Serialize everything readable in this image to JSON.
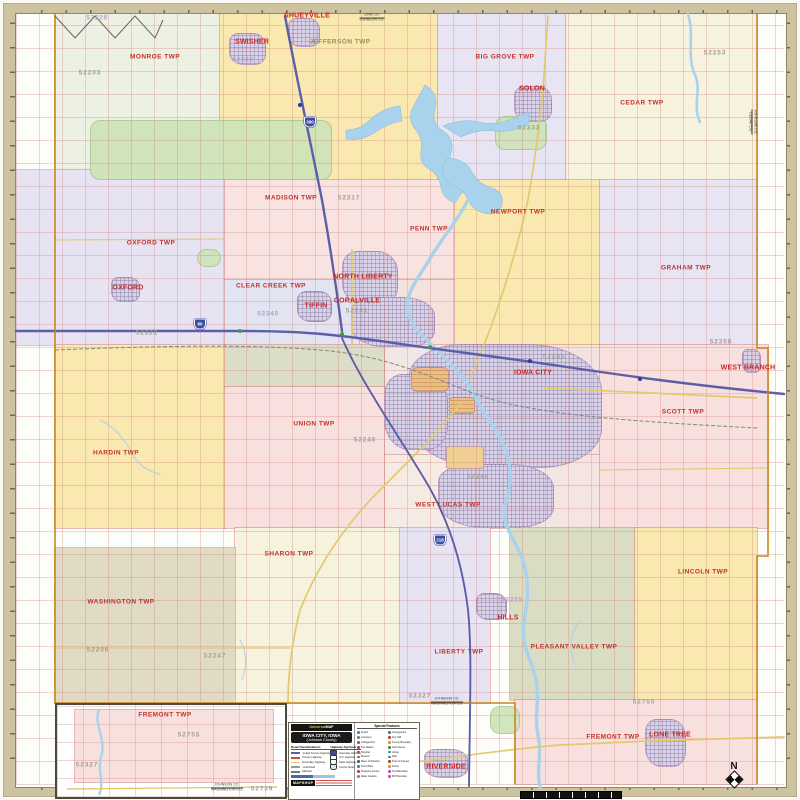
{
  "meta": {
    "product_title": "Iowa City, Iowa (Johnson County) wall map"
  },
  "palette": {
    "frame_tan": "#cdc3a1",
    "township_yellow": "#f9e8b0",
    "township_lavender": "#e8e4f3",
    "township_pink": "#f8e0de",
    "township_cream": "#f6f2de",
    "township_tan": "#e1dbc5",
    "township_olive": "#dadcc3",
    "urban_purple": "#d9d2e8",
    "water_blue": "#a9d2ec",
    "park_green": "#cde3b8",
    "interstate_purple": "#5c5fa8",
    "highway_yellow": "#e3c96e",
    "town_label_red": "#cc2522",
    "zip_gray": "#a29e8f",
    "zip_purple": "#b1a0c9",
    "county_line_orange": "#c8881f"
  },
  "map": {
    "regions": [
      {
        "id": "monroe-twp",
        "x": 55,
        "y": 14,
        "w": 165,
        "h": 156,
        "fill": "#edf1e3"
      },
      {
        "id": "jefferson-twp",
        "x": 220,
        "y": 14,
        "w": 218,
        "h": 166,
        "fill": "#f9e8b0"
      },
      {
        "id": "big-grove-twp",
        "x": 438,
        "y": 14,
        "w": 128,
        "h": 166,
        "fill": "#e8e4f3"
      },
      {
        "id": "cedar-twp",
        "x": 566,
        "y": 14,
        "w": 191,
        "h": 166,
        "fill": "#f6f2de"
      },
      {
        "id": "oxford-twp",
        "x": 16,
        "y": 170,
        "w": 209,
        "h": 175,
        "fill": "#e7e3f2"
      },
      {
        "id": "madison-twp",
        "x": 225,
        "y": 180,
        "w": 230,
        "h": 100,
        "fill": "#f8e3e1"
      },
      {
        "id": "clear-creek-twp",
        "x": 225,
        "y": 280,
        "w": 135,
        "h": 65,
        "fill": "#e3e4f1"
      },
      {
        "id": "penn-twp-south",
        "x": 360,
        "y": 280,
        "w": 95,
        "h": 65,
        "fill": "#f5e2dd"
      },
      {
        "id": "newport-twp",
        "x": 455,
        "y": 180,
        "w": 145,
        "h": 165,
        "fill": "#f9e8b0"
      },
      {
        "id": "graham-twp",
        "x": 600,
        "y": 180,
        "w": 157,
        "h": 165,
        "fill": "#e8e4f3"
      },
      {
        "id": "hardin-twp",
        "x": 55,
        "y": 345,
        "w": 170,
        "h": 183,
        "fill": "#f9e8b0"
      },
      {
        "id": "clear-creek-olive",
        "x": 225,
        "y": 345,
        "w": 160,
        "h": 42,
        "fill": "#dcddc6"
      },
      {
        "id": "union-twp",
        "x": 225,
        "y": 387,
        "w": 160,
        "h": 141,
        "fill": "#f8e0de"
      },
      {
        "id": "iowa-city-west-base",
        "x": 385,
        "y": 345,
        "w": 145,
        "h": 110,
        "fill": "#f1e7e7"
      },
      {
        "id": "iowa-city-east-base",
        "x": 530,
        "y": 345,
        "w": 70,
        "h": 110,
        "fill": "#f4e2e0"
      },
      {
        "id": "west-lucas-twp",
        "x": 385,
        "y": 455,
        "w": 145,
        "h": 73,
        "fill": "#f6ebe4"
      },
      {
        "id": "east-lucas-south",
        "x": 530,
        "y": 455,
        "w": 70,
        "h": 73,
        "fill": "#f4e4e2"
      },
      {
        "id": "scott-twp",
        "x": 600,
        "y": 345,
        "w": 168,
        "h": 183,
        "fill": "#f8e0de"
      },
      {
        "id": "sharon-twp",
        "x": 235,
        "y": 528,
        "w": 165,
        "h": 175,
        "fill": "#f6f2de"
      },
      {
        "id": "washington-twp",
        "x": 55,
        "y": 548,
        "w": 180,
        "h": 155,
        "fill": "#e1dbc5"
      },
      {
        "id": "liberty-twp",
        "x": 400,
        "y": 528,
        "w": 90,
        "h": 175,
        "fill": "#e7e3f2"
      },
      {
        "id": "pleasant-valley-twp",
        "x": 510,
        "y": 528,
        "w": 125,
        "h": 172,
        "fill": "#dadcc3"
      },
      {
        "id": "lincoln-twp",
        "x": 635,
        "y": 528,
        "w": 122,
        "h": 172,
        "fill": "#f9e8b0"
      },
      {
        "id": "fremont-twp",
        "x": 515,
        "y": 700,
        "w": 242,
        "h": 84,
        "fill": "#f8e0de"
      }
    ],
    "greens": [
      {
        "id": "hawkeye-wildlife-area",
        "x": 90,
        "y": 120,
        "w": 240,
        "h": 58
      },
      {
        "id": "lake-macbride-park",
        "x": 495,
        "y": 116,
        "w": 50,
        "h": 32
      },
      {
        "id": "kent-park",
        "x": 197,
        "y": 249,
        "w": 22,
        "h": 16
      },
      {
        "id": "river-junction-green",
        "x": 490,
        "y": 706,
        "w": 28,
        "h": 26
      }
    ],
    "urban_areas": [
      {
        "id": "shueyville-urban",
        "x": 288,
        "y": 18,
        "w": 30,
        "h": 27,
        "variant": ""
      },
      {
        "id": "swisher-urban",
        "x": 229,
        "y": 33,
        "w": 35,
        "h": 30,
        "variant": ""
      },
      {
        "id": "solon-urban",
        "x": 514,
        "y": 86,
        "w": 36,
        "h": 34,
        "variant": ""
      },
      {
        "id": "north-liberty-urban",
        "x": 342,
        "y": 251,
        "w": 54,
        "h": 52,
        "variant": ""
      },
      {
        "id": "tiffin-urban",
        "x": 297,
        "y": 291,
        "w": 33,
        "h": 29,
        "variant": ""
      },
      {
        "id": "coralville-urban",
        "x": 351,
        "y": 297,
        "w": 82,
        "h": 48,
        "variant": ""
      },
      {
        "id": "oxford-urban",
        "x": 111,
        "y": 277,
        "w": 27,
        "h": 23,
        "variant": ""
      },
      {
        "id": "iowa-city-urban-a",
        "x": 408,
        "y": 344,
        "w": 192,
        "h": 122,
        "variant": ""
      },
      {
        "id": "iowa-city-urban-b",
        "x": 384,
        "y": 374,
        "w": 62,
        "h": 74,
        "variant": ""
      },
      {
        "id": "iowa-city-urban-c",
        "x": 438,
        "y": 464,
        "w": 114,
        "h": 62,
        "variant": ""
      },
      {
        "id": "university-campus",
        "x": 411,
        "y": 367,
        "w": 36,
        "h": 23,
        "variant": "orange"
      },
      {
        "id": "campus-east",
        "x": 449,
        "y": 397,
        "w": 24,
        "h": 15,
        "variant": "orange"
      },
      {
        "id": "iowa-city-airport",
        "x": 446,
        "y": 446,
        "w": 36,
        "h": 21,
        "variant": "airport"
      },
      {
        "id": "hills-urban",
        "x": 476,
        "y": 593,
        "w": 29,
        "h": 25,
        "variant": ""
      },
      {
        "id": "riverside-urban",
        "x": 424,
        "y": 749,
        "w": 42,
        "h": 27,
        "variant": ""
      },
      {
        "id": "lone-tree-urban",
        "x": 645,
        "y": 719,
        "w": 39,
        "h": 46,
        "variant": ""
      },
      {
        "id": "west-branch-urban",
        "x": 742,
        "y": 349,
        "w": 17,
        "h": 22,
        "variant": ""
      }
    ],
    "townships": [
      {
        "name": "MONROE TWP",
        "x": 155,
        "y": 57,
        "style": ""
      },
      {
        "name": "JEFFERSON TWP",
        "x": 340,
        "y": 42,
        "style": "olive"
      },
      {
        "name": "BIG GROVE TWP",
        "x": 505,
        "y": 57,
        "style": ""
      },
      {
        "name": "CEDAR TWP",
        "x": 642,
        "y": 103,
        "style": ""
      },
      {
        "name": "MADISON TWP",
        "x": 291,
        "y": 198,
        "style": ""
      },
      {
        "name": "PENN TWP",
        "x": 429,
        "y": 229,
        "style": ""
      },
      {
        "name": "NEWPORT TWP",
        "x": 518,
        "y": 212,
        "style": ""
      },
      {
        "name": "GRAHAM TWP",
        "x": 686,
        "y": 268,
        "style": ""
      },
      {
        "name": "OXFORD TWP",
        "x": 151,
        "y": 243,
        "style": ""
      },
      {
        "name": "CLEAR CREEK TWP",
        "x": 271,
        "y": 286,
        "style": ""
      },
      {
        "name": "UNION TWP",
        "x": 314,
        "y": 424,
        "style": ""
      },
      {
        "name": "HARDIN TWP",
        "x": 116,
        "y": 453,
        "style": ""
      },
      {
        "name": "SCOTT TWP",
        "x": 683,
        "y": 412,
        "style": ""
      },
      {
        "name": "WEST LUCAS TWP",
        "x": 448,
        "y": 505,
        "style": ""
      },
      {
        "name": "SHARON TWP",
        "x": 289,
        "y": 554,
        "style": ""
      },
      {
        "name": "WASHINGTON TWP",
        "x": 121,
        "y": 602,
        "style": ""
      },
      {
        "name": "LIBERTY TWP",
        "x": 459,
        "y": 652,
        "style": ""
      },
      {
        "name": "PLEASANT VALLEY TWP",
        "x": 574,
        "y": 647,
        "style": ""
      },
      {
        "name": "LINCOLN TWP",
        "x": 703,
        "y": 572,
        "style": ""
      },
      {
        "name": "FREMONT TWP",
        "x": 613,
        "y": 737,
        "style": ""
      }
    ],
    "cities": [
      {
        "name": "SHUEYVILLE",
        "x": 307,
        "y": 16
      },
      {
        "name": "SWISHER",
        "x": 252,
        "y": 42
      },
      {
        "name": "SOLON",
        "x": 532,
        "y": 89
      },
      {
        "name": "OXFORD",
        "x": 128,
        "y": 288
      },
      {
        "name": "TIFFIN",
        "x": 316,
        "y": 306
      },
      {
        "name": "CORALVILLE",
        "x": 357,
        "y": 301
      },
      {
        "name": "NORTH LIBERTY",
        "x": 363,
        "y": 277
      },
      {
        "name": "IOWA CITY",
        "x": 533,
        "y": 373
      },
      {
        "name": "HILLS",
        "x": 508,
        "y": 618
      },
      {
        "name": "RIVERSIDE",
        "x": 446,
        "y": 767
      },
      {
        "name": "LONE TREE",
        "x": 670,
        "y": 735
      },
      {
        "name": "WEST BRANCH",
        "x": 748,
        "y": 368
      }
    ],
    "zips": [
      {
        "code": "52228",
        "x": 97,
        "y": 18,
        "style": "p"
      },
      {
        "code": "52203",
        "x": 90,
        "y": 73,
        "style": "g"
      },
      {
        "code": "52338",
        "x": 243,
        "y": 60,
        "style": "p"
      },
      {
        "code": "52333",
        "x": 529,
        "y": 128,
        "style": "g"
      },
      {
        "code": "52253",
        "x": 715,
        "y": 53,
        "style": "g"
      },
      {
        "code": "52317",
        "x": 349,
        "y": 198,
        "style": "g"
      },
      {
        "code": "52322",
        "x": 147,
        "y": 333,
        "style": "g"
      },
      {
        "code": "52340",
        "x": 268,
        "y": 314,
        "style": "p"
      },
      {
        "code": "52241",
        "x": 357,
        "y": 311,
        "style": "g"
      },
      {
        "code": "52245",
        "x": 554,
        "y": 357,
        "style": "g"
      },
      {
        "code": "52246",
        "x": 365,
        "y": 440,
        "style": "g"
      },
      {
        "code": "52240",
        "x": 478,
        "y": 477,
        "style": "g"
      },
      {
        "code": "52358",
        "x": 721,
        "y": 342,
        "style": "g"
      },
      {
        "code": "52235",
        "x": 512,
        "y": 600,
        "style": "p"
      },
      {
        "code": "52327",
        "x": 420,
        "y": 696,
        "style": "g"
      },
      {
        "code": "52206",
        "x": 98,
        "y": 650,
        "style": "g"
      },
      {
        "code": "52247",
        "x": 215,
        "y": 656,
        "style": "g"
      },
      {
        "code": "52755",
        "x": 644,
        "y": 702,
        "style": "g"
      }
    ],
    "county_lines": [
      {
        "text": "LINN CO.",
        "text2": "JOHNSON CO.",
        "x": 372,
        "y": 18,
        "vertical": false
      },
      {
        "text": "JOHNSON CO.",
        "text2": "WASHINGTON CO.",
        "x": 447,
        "y": 702,
        "vertical": false
      },
      {
        "text": "JOHNSON CO.",
        "text2": "CEDAR CO.",
        "x": 752,
        "y": 122,
        "vertical": true
      }
    ],
    "shields": [
      {
        "num": "80",
        "x": 200,
        "y": 324
      },
      {
        "num": "380",
        "x": 310,
        "y": 122
      },
      {
        "num": "218",
        "x": 440,
        "y": 540
      }
    ]
  },
  "inset": {
    "labels": [
      {
        "text": "FREMONT TWP",
        "x": 108,
        "y": 10,
        "style": "twp"
      },
      {
        "text": "52755",
        "x": 132,
        "y": 30,
        "style": "zip-g"
      },
      {
        "text": "52327",
        "x": 30,
        "y": 60,
        "style": "zip-g"
      },
      {
        "text": "52739",
        "x": 205,
        "y": 84,
        "style": "zip-g"
      },
      {
        "text": "JOHNSON CO.",
        "text2": "WASHINGTON CO.",
        "x": 170,
        "y": 83,
        "style": "county"
      }
    ]
  },
  "legend": {
    "brand_prefix": "Universal",
    "brand_suffix": "MAP",
    "title_line1": "IOWA CITY, IOWA",
    "title_line2": "(Johnson County)",
    "col1_header": "Road Classifications",
    "col2_header": "Highway Symbols",
    "road_classes": [
      {
        "label": "Limited Access Highway",
        "color": "#5c5fa8"
      },
      {
        "label": "Primary Highway",
        "color": "#c0504d"
      },
      {
        "label": "Secondary Highway",
        "color": "#e3c96e"
      },
      {
        "label": "Local Road",
        "color": "#999999"
      },
      {
        "label": "Railroad",
        "color": "#777777"
      }
    ],
    "hwy_symbols": [
      {
        "label": "Interstate Highway",
        "color": "#3c4d9e"
      },
      {
        "label": "U.S. Highway",
        "color": "#ffffff"
      },
      {
        "label": "State Highway",
        "color": "#ffffff"
      },
      {
        "label": "County Road",
        "color": "#dce7f4"
      }
    ],
    "special_header": "Special Features",
    "special": [
      {
        "label": "Airport",
        "color": "#3a7fc1"
      },
      {
        "label": "Campground",
        "color": "#2e8b57"
      },
      {
        "label": "Cemetery",
        "color": "#777777"
      },
      {
        "label": "City Hall",
        "color": "#c0392b"
      },
      {
        "label": "College/Univ.",
        "color": "#8e44ad"
      },
      {
        "label": "County Boundary",
        "color": "#d4941f"
      },
      {
        "label": "Fire Station",
        "color": "#c0392b"
      },
      {
        "label": "Golf Course",
        "color": "#2e8b57"
      },
      {
        "label": "Hospital",
        "color": "#c0392b"
      },
      {
        "label": "Library",
        "color": "#3a7fc1"
      },
      {
        "label": "Museum",
        "color": "#8e44ad"
      },
      {
        "label": "Park",
        "color": "#2e8b57"
      },
      {
        "label": "Place of Worship",
        "color": "#555555"
      },
      {
        "label": "Point of Interest",
        "color": "#c0392b"
      },
      {
        "label": "Post Office",
        "color": "#3a7fc1"
      },
      {
        "label": "School",
        "color": "#d4941f"
      },
      {
        "label": "Shopping Center",
        "color": "#c0392b"
      },
      {
        "label": "Twp Boundary",
        "color": "#b84cc0"
      },
      {
        "label": "Water Feature",
        "color": "#3a9bd5"
      },
      {
        "label": "ZIP Boundary",
        "color": "#c850a0"
      }
    ],
    "mapshop": "MAPSHOP"
  },
  "north": {
    "label": "N"
  }
}
